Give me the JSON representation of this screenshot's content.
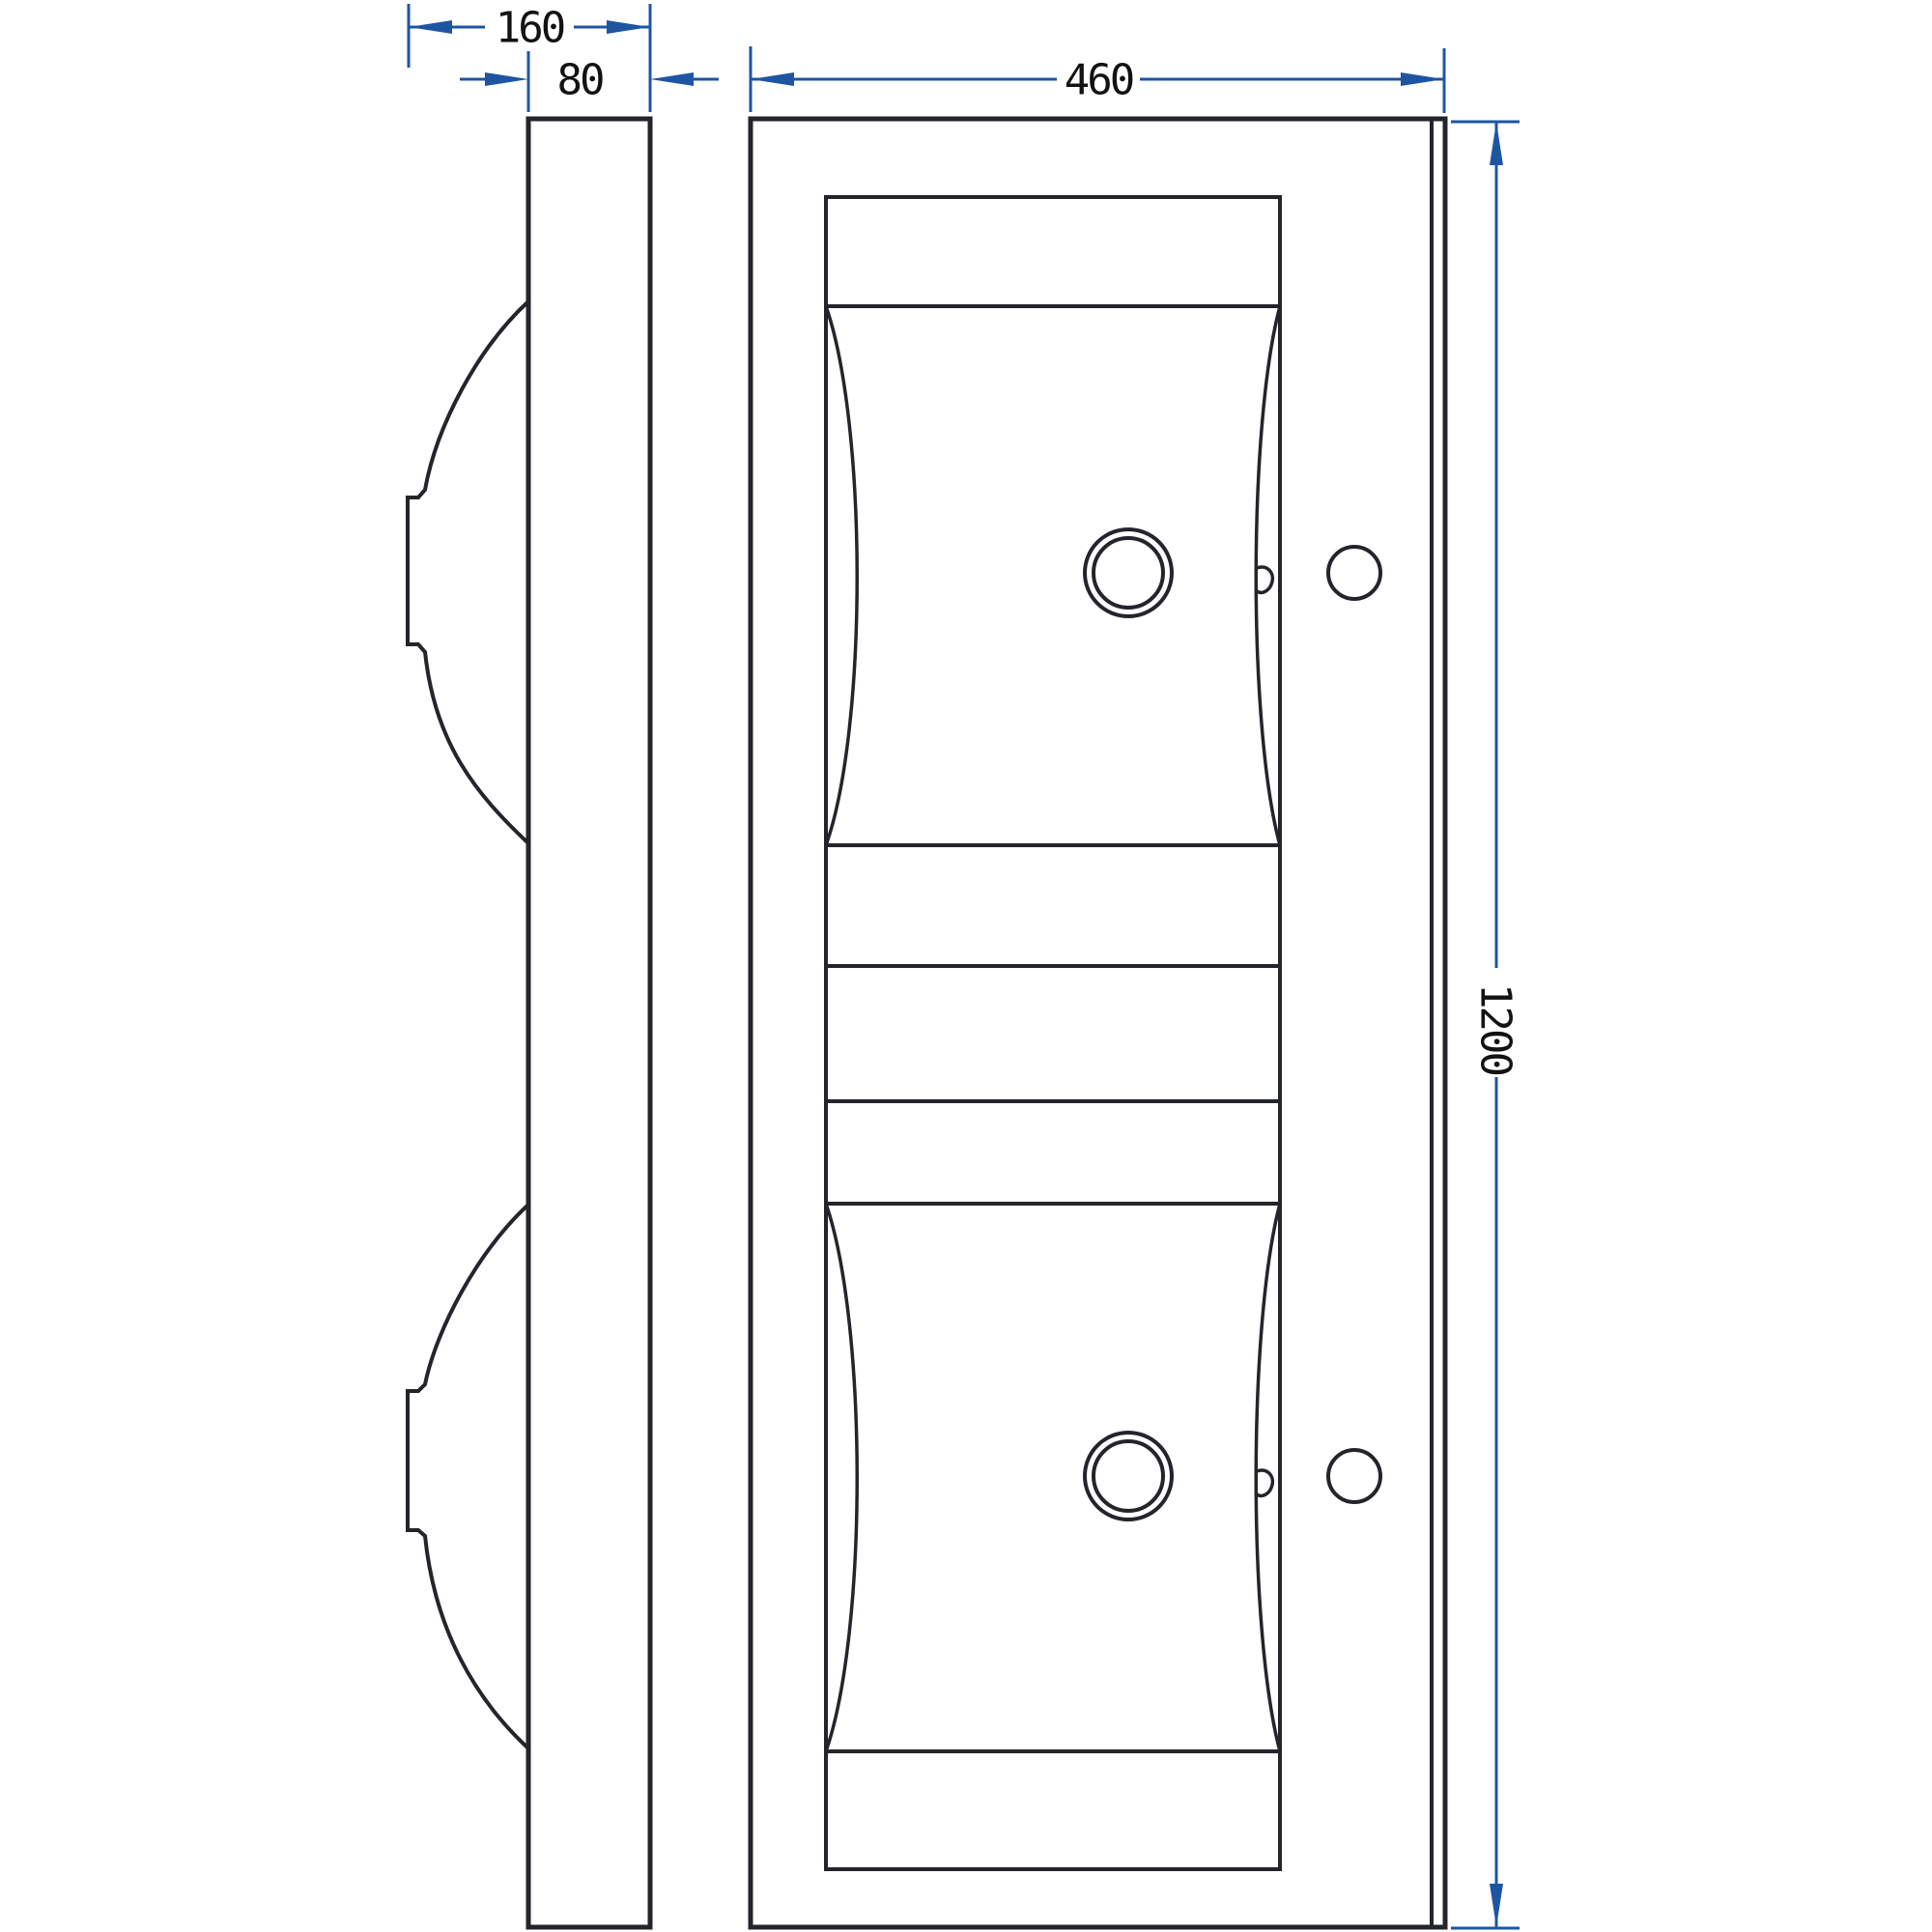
{
  "drawing": {
    "type": "technical-drawing",
    "subject": "double-basin washtrough, side profile and plan view",
    "dimensions": {
      "total_depth": {
        "value": "160"
      },
      "slab_thickness": {
        "value": "80"
      },
      "plan_width": {
        "value": "460"
      },
      "plan_height": {
        "value": "1200"
      }
    },
    "colors": {
      "background": "#ffffff",
      "line": "#23252b",
      "dimension": "#1e55a3",
      "text": "#121212"
    }
  }
}
